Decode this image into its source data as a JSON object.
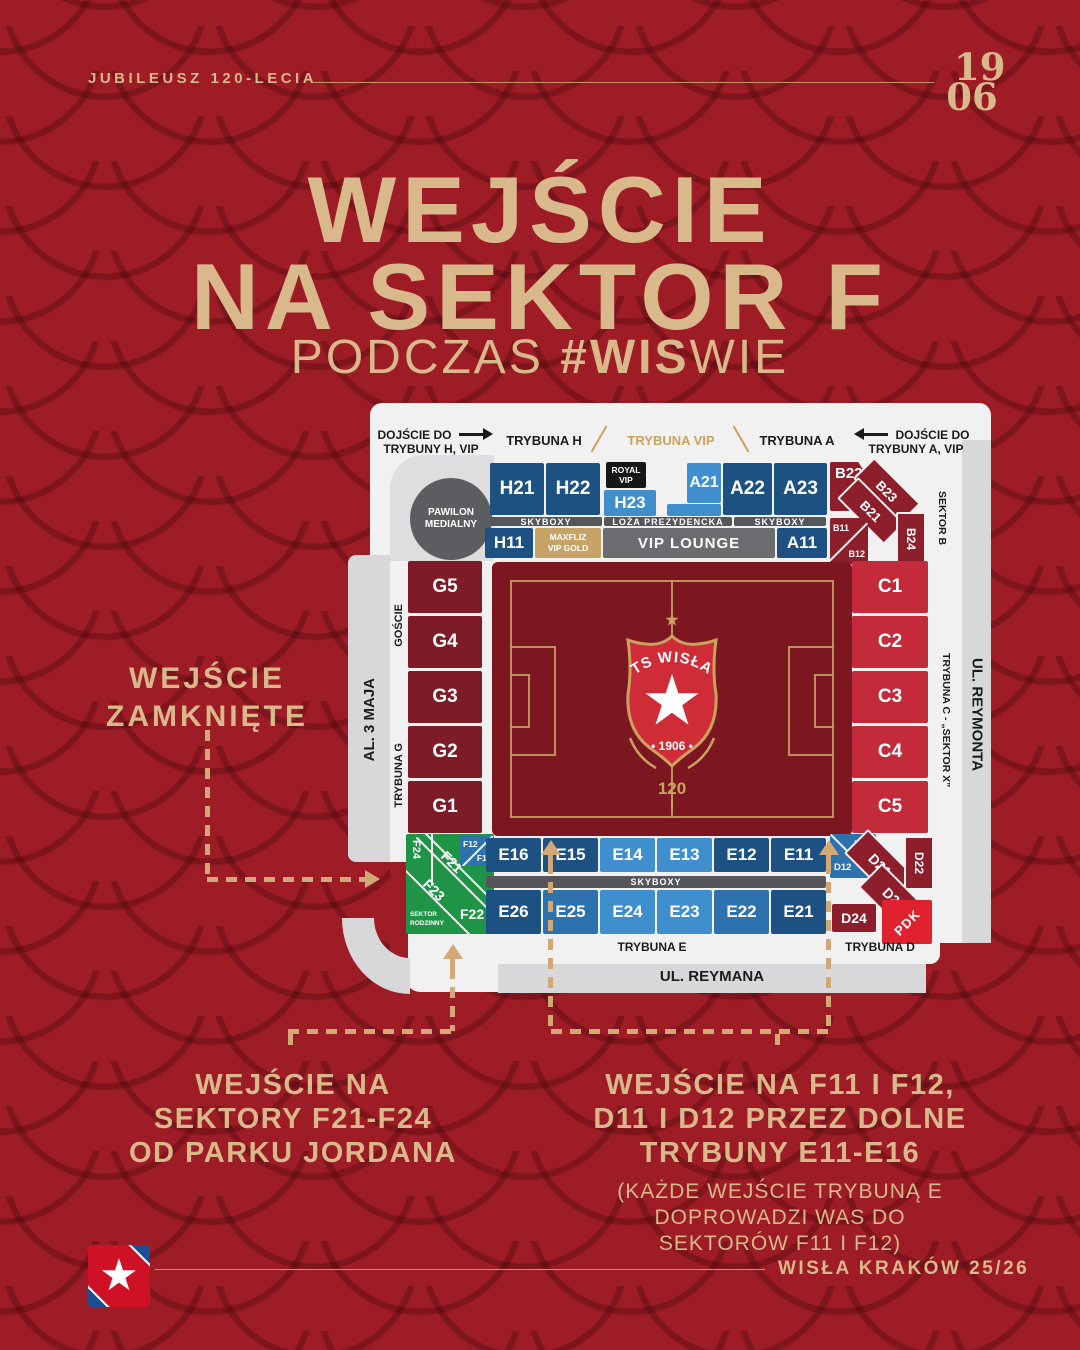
{
  "header": {
    "jubilee_label": "JUBILEUSZ 120-LECIA",
    "year_line1": "19",
    "year_line2": "06"
  },
  "title": {
    "line1": "WEJŚCIE",
    "line2": "NA SEKTOR F",
    "subtitle_prefix": "PODCZAS ",
    "subtitle_bold": "#WIS",
    "subtitle_suffix": "WIE"
  },
  "closed_note": {
    "line1": "WEJŚCIE",
    "line2": "ZAMKNIĘTE"
  },
  "bottom_left_note": {
    "line1": "WEJŚCIE NA",
    "line2": "SEKTORY F21-F24",
    "line3": "OD PARKU JORDANA"
  },
  "bottom_right_note": {
    "line1": "WEJŚCIE NA F11 I F12,",
    "line2": "D11 I D12 PRZEZ DOLNE",
    "line3": "TRYBUNY E11-E16",
    "sub1": "(KAŻDE WEJŚCIE TRYBUNĄ E",
    "sub2": "DOPROWADZI WAS DO",
    "sub3": "SEKTORÓW F11 I F12)"
  },
  "footer": {
    "club_season": "WISŁA KRAKÓW 25/26"
  },
  "stadium": {
    "access_h": {
      "line1": "DOJŚCIE DO",
      "line2": "TRYBUNY H, VIP"
    },
    "access_a": {
      "line1": "DOJŚCIE DO",
      "line2": "TRYBUNY A, VIP"
    },
    "stand_h": "TRYBUNA H",
    "stand_vip": "TRYBUNA VIP",
    "stand_a": "TRYBUNA A",
    "stand_e": "TRYBUNA E",
    "stand_d": "TRYBUNA D",
    "stand_g": "TRYBUNA G",
    "stand_c": "TRYBUNA C - „SEKTOR X”",
    "sektor_b": "SEKTOR B",
    "goscie": "GOŚCIE",
    "street_left": "AL. 3 MAJA",
    "street_right": "UL. REYMONTA",
    "street_bottom": "UL. REYMANA",
    "pawilon_line1": "PAWILON",
    "pawilon_line2": "MEDIALNY",
    "royal_line1": "ROYAL",
    "royal_line2": "VIP",
    "skyboxy": "SKYBOXY",
    "loza": "LOŻA PREZYDENCKA",
    "maxfliz_line1": "MAXFLIZ",
    "maxfliz_line2": "VIP GOLD",
    "vip_lounge": "VIP LOUNGE",
    "sektor_rodzinny_line1": "SEKTOR",
    "sektor_rodzinny_line2": "RODZINNY",
    "pdk": "PDK",
    "sections": {
      "h21": "H21",
      "h22": "H22",
      "h23": "H23",
      "h11": "H11",
      "a21": "A21",
      "a22": "A22",
      "a23": "A23",
      "a11": "A11",
      "b22": "B22",
      "b23": "B23",
      "b21": "B21",
      "b24": "B24",
      "b11": "B11",
      "b12": "B12",
      "g": [
        "G5",
        "G4",
        "G3",
        "G2",
        "G1"
      ],
      "c": [
        "C1",
        "C2",
        "C3",
        "C4",
        "C5"
      ],
      "e_upper": [
        "E16",
        "E15",
        "E14",
        "E13",
        "E12",
        "E11"
      ],
      "e_lower": [
        "E26",
        "E25",
        "E24",
        "E23",
        "E22",
        "E21"
      ],
      "f24": "F24",
      "f21": "F21",
      "f23": "F23",
      "f22": "F22",
      "f12": "F12",
      "f11": "F11",
      "d11": "D11",
      "d12": "D12",
      "d21": "D21",
      "d22": "D22",
      "d23": "D23",
      "d24": "D24"
    },
    "crest": {
      "club": "TS WISŁA",
      "year": "• 1906 •",
      "anniversary": "120"
    }
  },
  "colors": {
    "background": "#9e1c25",
    "tan": "#d9b88c",
    "gold": "#c9a25f",
    "navy": "#1d5181",
    "light_blue": "#3f8ecd",
    "maroon": "#8c1f2b",
    "bright_red": "#c42b3a",
    "green": "#1f9447",
    "gray": "#6a6c70",
    "pitch": "#7c1621",
    "pdk_red": "#e0212f"
  }
}
